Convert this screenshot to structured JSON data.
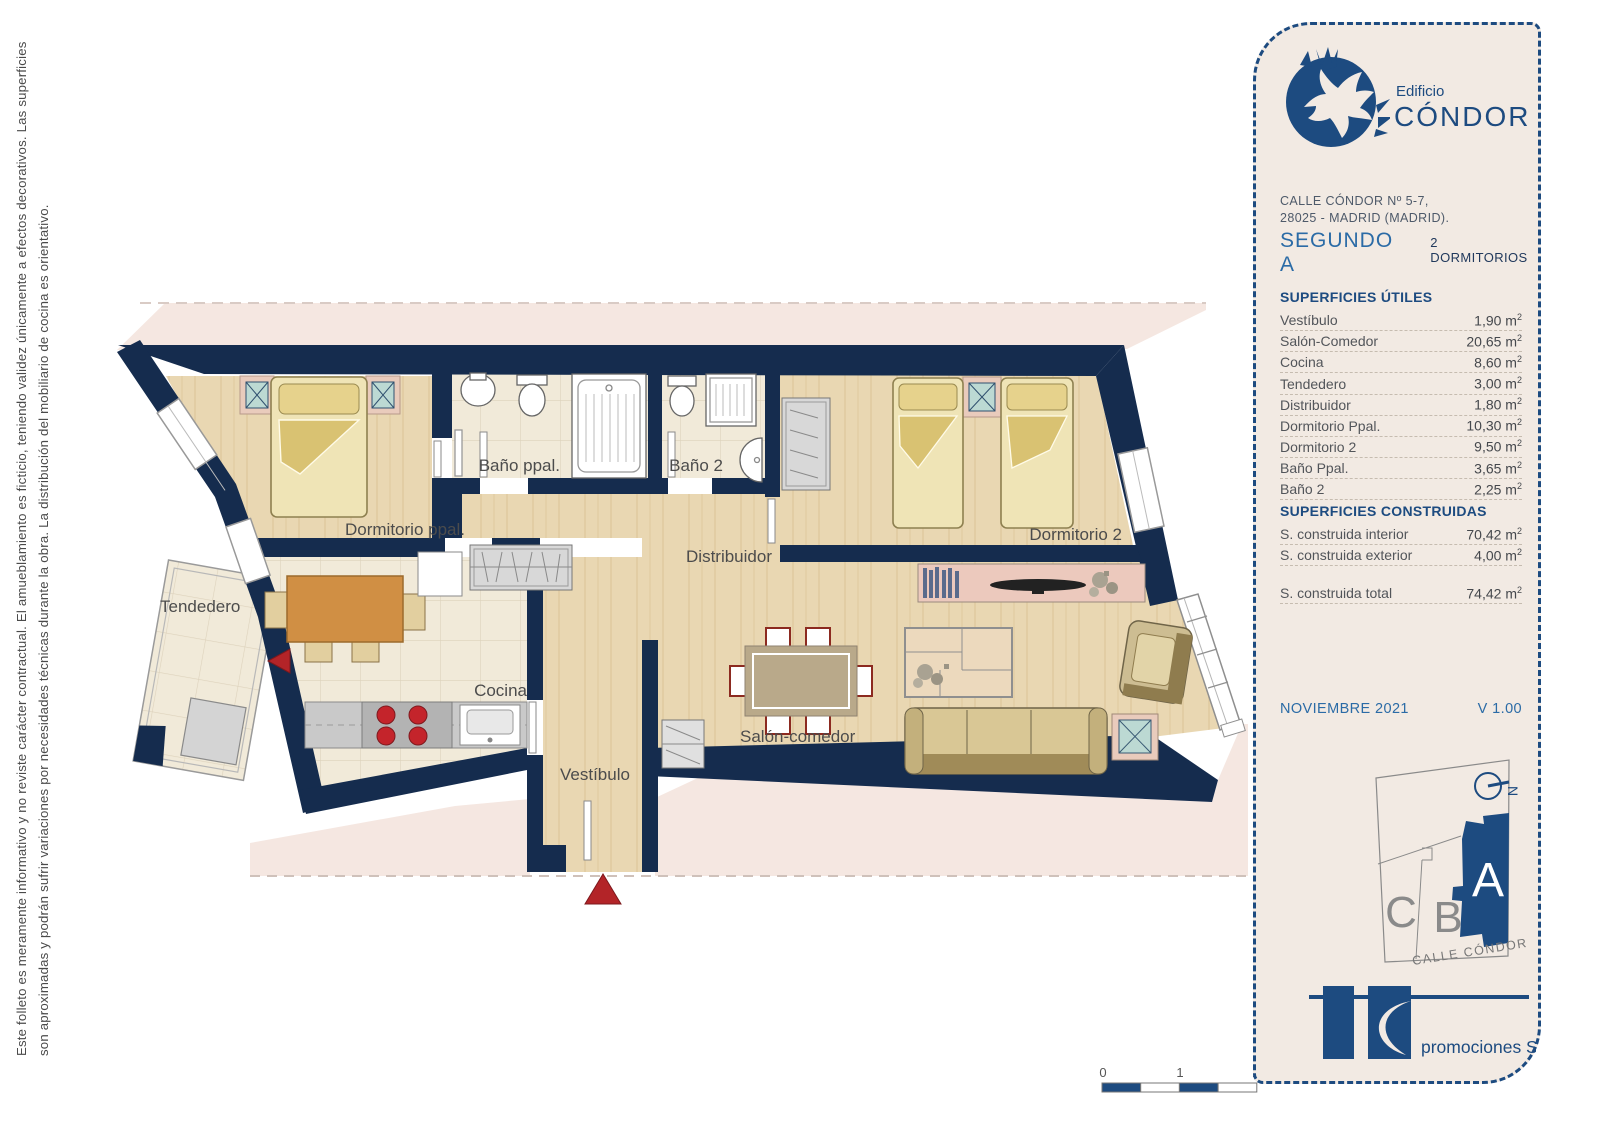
{
  "disclaimer": {
    "line1": "Este folleto es meramente informativo y no reviste carácter contractual. El amueblamiento es ficticio, teniendo validez únicamente a efectos decorativos. Las superficies",
    "line2": "son aproximadas y podrán sufrir variaciones por necesidades técnicas durante la obra. La distribución del mobiliario de cocina es orientativo."
  },
  "plan": {
    "rooms": {
      "tendedero": "Tendedero",
      "dormitorio_ppal": "Dormitorio ppal.",
      "bano_ppal": "Baño ppal.",
      "bano_2": "Baño 2",
      "distribuidor": "Distribuidor",
      "dormitorio_2": "Dormitorio 2",
      "cocina": "Cocina",
      "vestibulo": "Vestíbulo",
      "salon_comedor": "Salón-comedor"
    },
    "scale": {
      "t0": "0",
      "t1": "1",
      "t2": "2"
    }
  },
  "panel": {
    "building_label": "Edificio",
    "building_name": "CÓNDOR",
    "address_line1": "CALLE CÓNDOR Nº 5-7,",
    "address_line2": "28025 -  MADRID (MADRID).",
    "unit": "SEGUNDO A",
    "bedrooms": "2 DORMITORIOS",
    "useful_title": "SUPERFICIES ÚTILES",
    "useful_rows": [
      {
        "label": "Vestíbulo",
        "value": "1,90"
      },
      {
        "label": "Salón-Comedor",
        "value": "20,65"
      },
      {
        "label": "Cocina",
        "value": "8,60"
      },
      {
        "label": "Tendedero",
        "value": "3,00"
      },
      {
        "label": "Distribuidor",
        "value": "1,80"
      },
      {
        "label": "Dormitorio Ppal.",
        "value": "10,30"
      },
      {
        "label": "Dormitorio 2",
        "value": "9,50"
      },
      {
        "label": "Baño Ppal.",
        "value": "3,65"
      },
      {
        "label": "Baño 2",
        "value": "2,25"
      }
    ],
    "built_title": "SUPERFICIES CONSTRUIDAS",
    "built_rows": [
      {
        "label": "S. construida interior",
        "value": "70,42"
      },
      {
        "label": "S. construida exterior",
        "value": "4,00"
      },
      {
        "label": "S. construida total",
        "value": "74,42",
        "gap": true
      }
    ],
    "date": "NOVIEMBRE 2021",
    "version": "V 1.00",
    "keyplan": {
      "unit_a": "A",
      "unit_b": "B",
      "unit_c": "C",
      "street": "CALLE CÓNDOR",
      "north": "N"
    },
    "logo_text": "promociones S.L.",
    "colors": {
      "navy": "#152c4e",
      "blue": "#2b6ba6",
      "heading": "#1d4b80",
      "pink": "#f5e7e1"
    }
  }
}
